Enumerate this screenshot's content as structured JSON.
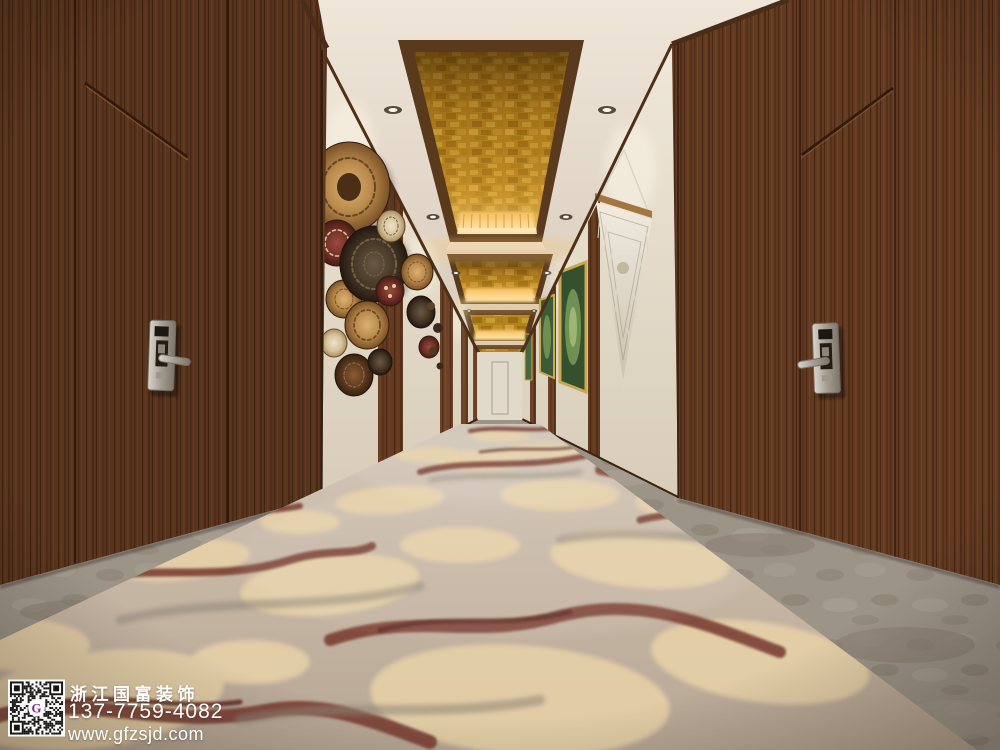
{
  "meta": {
    "title": "Hotel guestroom corridor interior rendering",
    "scene_type": "photo-render"
  },
  "watermark": {
    "company": "浙江国富装饰",
    "phone": "137-7759-4082",
    "website": "www.gfzsjd.com",
    "text_color": "#ffffff",
    "qr": {
      "icon": "qr-code-icon",
      "logo_letter": "G",
      "logo_color": "#8a2a8c",
      "module_color": "#161616",
      "background": "#ffffff"
    }
  },
  "scene": {
    "description": "Long hotel corridor with dark walnut door walls on both sides, cream textured accent walls, a cluster of woven basket wall plates on the left, a white macrame wall hanging and gold-framed green artwork on the right, backlit gold-leaf recessed ceiling coffers with downlights, and a marble-swirl patterned carpet in taupe, cream and maroon with grey stone border strips.",
    "elements": [
      "left-door-wall",
      "right-door-wall",
      "door-lock-left",
      "door-lock-right",
      "ceiling",
      "gold-ceiling-coffers",
      "downlights",
      "left-accent-wall",
      "right-accent-wall",
      "wall-plates-cluster",
      "macrame-wall-hanging",
      "framed-artworks",
      "far-end-wall",
      "stone-floor-border",
      "patterned-carpet"
    ],
    "colors": {
      "wood": "#6d4125",
      "ceiling_cream": "#e8dfd2",
      "gold_leaf": "#b5831e",
      "cove_light": "#ffd98a",
      "accent_wall": "#e7decd",
      "carpet_base": "#c3b3a1",
      "carpet_cream": "#e8d2a8",
      "carpet_maroon": "#7c4134",
      "stone_border": "#9c9488"
    }
  }
}
